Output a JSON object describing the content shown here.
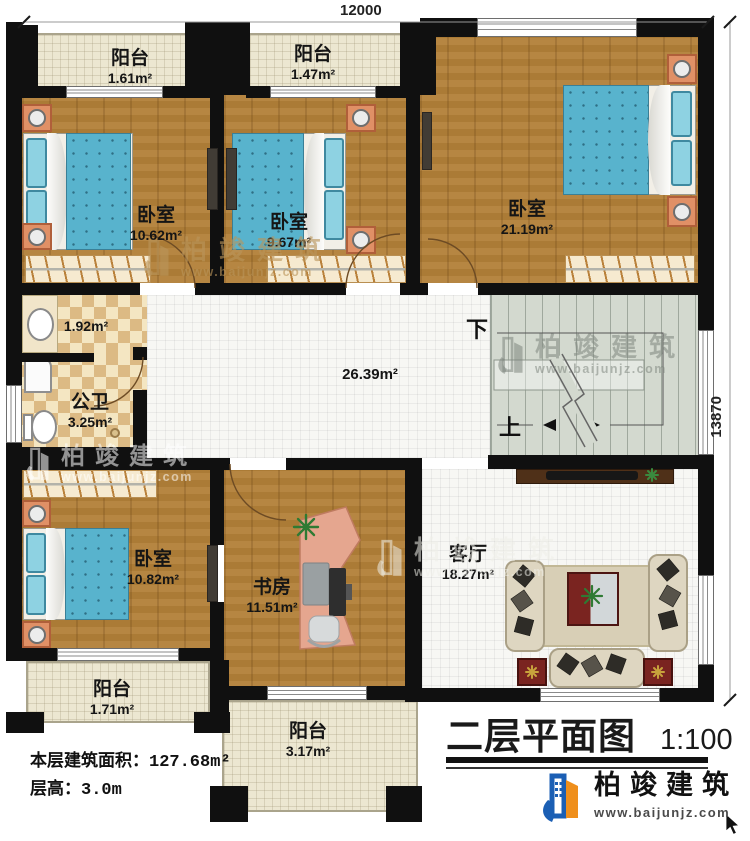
{
  "dimensions": {
    "width_top": "12000",
    "height_right": "13870"
  },
  "rooms": {
    "balcony_tl": {
      "name": "阳台",
      "area": "1.61m²"
    },
    "balcony_tm": {
      "name": "阳台",
      "area": "1.47m²"
    },
    "bedroom_tl": {
      "name": "卧室",
      "area": "10.62m²"
    },
    "bedroom_tm": {
      "name": "卧室",
      "area": "9.67m²"
    },
    "bedroom_tr": {
      "name": "卧室",
      "area": "21.19m²"
    },
    "vanity": {
      "area": "1.92m²"
    },
    "bathroom": {
      "name": "公卫",
      "area": "3.25m²"
    },
    "hallway": {
      "area": "26.39m²"
    },
    "bedroom_bl": {
      "name": "卧室",
      "area": "10.82m²"
    },
    "study": {
      "name": "书房",
      "area": "11.51m²"
    },
    "living": {
      "name": "客厅",
      "area": "18.27m²"
    },
    "balcony_bl": {
      "name": "阳台",
      "area": "1.71m²"
    },
    "balcony_bm": {
      "name": "阳台",
      "area": "3.17m²"
    }
  },
  "stairs": {
    "down_label": "下",
    "up_label": "上"
  },
  "notes": {
    "floor_area_label": "本层建筑面积：",
    "floor_area_value": "127.68m²",
    "height_label": "层高：",
    "height_value": "3.0m"
  },
  "titleblock": {
    "title": "二层平面图",
    "scale": "1:100"
  },
  "brand": {
    "name": "柏竣建筑",
    "url": "www.baijunjz.com"
  },
  "watermark": {
    "name": "柏竣建筑",
    "url": "www.baijunjz.com"
  },
  "colors": {
    "wall": "#101010",
    "wood_floor": "#b28038",
    "warm_tile": "#ece7d1",
    "white_tile": "#f7f7f4",
    "checker_dark": "#dcba84",
    "checker_light": "#f4e6c2",
    "stairs": "#d3d9cf",
    "bed_blue": "#58b3cd",
    "brand_blue": "#1b5fb4",
    "brand_orange": "#ef8f1c"
  }
}
